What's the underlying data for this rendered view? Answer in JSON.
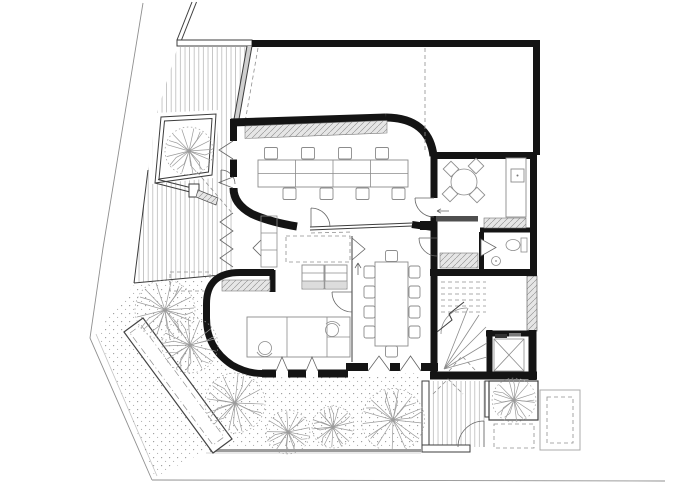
{
  "plan": {
    "label": "ground-floor-architectural-plan"
  },
  "colors": {
    "wall": "#141414",
    "thin": "#3d3d3d",
    "furniture": "#8c8c8c",
    "door": "#666666",
    "dashed": "#909090",
    "boundary": "#8f8f8f",
    "tree": "#9b9b9b",
    "grayfill": "#dcdcdc",
    "counter": "#4f4f4f",
    "hatch": "#a0a0a0",
    "dot": "#949494"
  },
  "elements": {
    "rooms": [
      "open-office",
      "kitchen-lunch-room",
      "wc-lobby",
      "wc",
      "stairwell",
      "elevator",
      "meeting-room",
      "corridor",
      "studio",
      "walled-courtyard"
    ],
    "furniture": [
      "office-desk-bank",
      "desk-chairs",
      "round-table",
      "dining-chairs",
      "kitchen-counter",
      "sink",
      "toilet",
      "washbasin",
      "meeting-table",
      "meeting-chairs",
      "shelf-divider",
      "tall-cabinet",
      "studio-desks",
      "task-chairs",
      "wall-cabinet"
    ],
    "landscape": [
      "timber-deck",
      "stippled-garden",
      "garden-trees",
      "courtyard-tree",
      "entry-tree",
      "bench-planter",
      "entry-path",
      "planter-outline",
      "site-boundary"
    ],
    "tree_count": 8
  }
}
